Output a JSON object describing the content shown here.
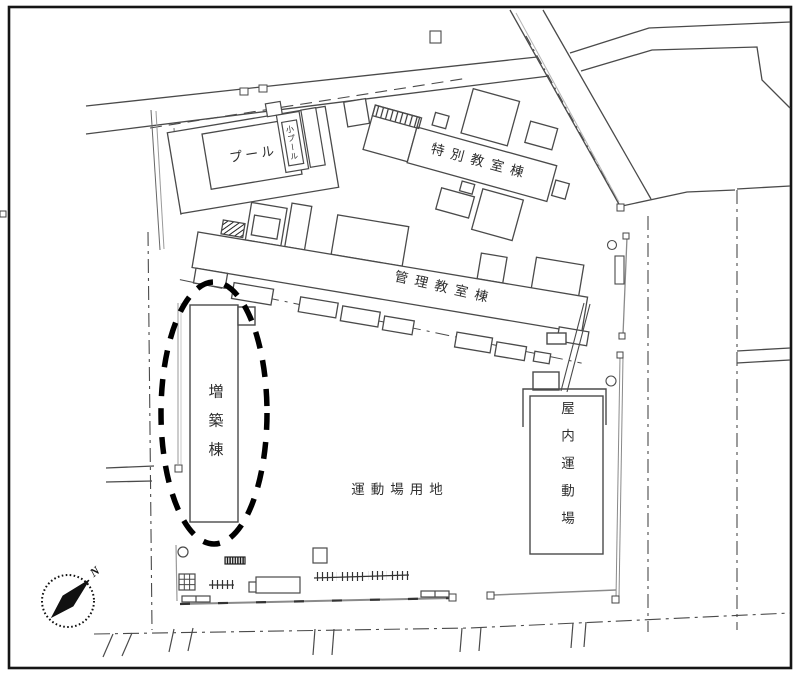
{
  "plan": {
    "labels": {
      "pool": "プール",
      "small_pool": "小プール",
      "special_classroom_bldg": "特別教室棟",
      "admin_classroom_bldg": "管理教室棟",
      "extension_bldg": "増築棟",
      "sports_ground": "運動場用地",
      "indoor_gym": "屋内運動場",
      "compass_north": "N"
    },
    "colors": {
      "line": "#4a4a4a",
      "light_line": "#8a8a8a",
      "highlight": "#000000",
      "frame": "#151515",
      "background": "#ffffff"
    }
  }
}
